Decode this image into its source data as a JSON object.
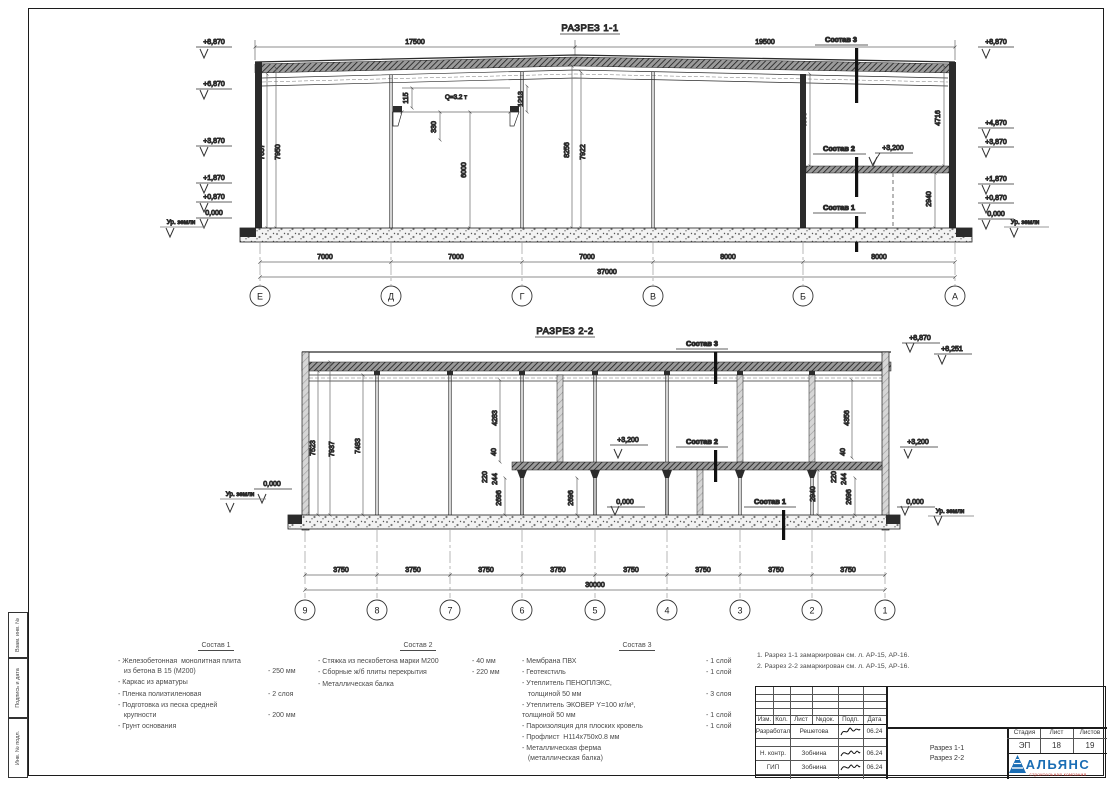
{
  "frame": {
    "side_stamp": {
      "cells": [
        "Взам. инв. №",
        "Подпись и дата",
        "Инв. № подл."
      ]
    }
  },
  "s1": {
    "title": "РАЗРЕЗ 1-1",
    "dim_top_left": "17500",
    "dim_top_right": "19500",
    "elev_left": {
      "e0": "+8,870",
      "e1": "+6,870",
      "e2": "+3,870",
      "e3": "+1,870",
      "e4": "+0,870",
      "e5": "0,000",
      "ground": "Ур. земли"
    },
    "elev_right": {
      "e0": "+8,870",
      "e1": "+4,870",
      "e2": "+3,870",
      "e3": "+1,870",
      "e4": "+0,870",
      "e5": "0,000",
      "ground": "Ур. земли"
    },
    "vdim": {
      "v7657": "7657",
      "v7950": "7950",
      "v115": "115",
      "v330": "330",
      "v6000": "6000",
      "v1213": "1213",
      "v8256": "8256",
      "v7922": "7922",
      "v4855": "4855",
      "v4716": "4716",
      "v2940": "2940"
    },
    "crane": "Q=3.2 т",
    "mezz_elev": "+3,200",
    "callout1": "Состав 1",
    "callout2": "Состав 2",
    "callout3": "Состав 3",
    "dims_bottom": [
      "7000",
      "7000",
      "7000",
      "8000",
      "8000"
    ],
    "dim_total": "37000",
    "axes": [
      "Е",
      "Д",
      "Г",
      "В",
      "Б",
      "А"
    ]
  },
  "s2": {
    "title": "РАЗРЕЗ 2-2",
    "elev": {
      "p8870": "+8,870",
      "p8251": "+8,251",
      "p3200": "+3,200",
      "zero": "0,000",
      "ground": "Ур. земли"
    },
    "vdim": {
      "v7523": "7523",
      "v7937": "7937",
      "v7483": "7483",
      "v4283": "4283",
      "v40": "40",
      "v220": "220",
      "v244": "244",
      "v2696": "2696",
      "v2940": "2940",
      "v4356": "4356"
    },
    "callout1": "Состав 1",
    "callout2": "Состав 2",
    "callout3": "Состав 3",
    "dims_bottom": [
      "3750",
      "3750",
      "3750",
      "3750",
      "3750",
      "3750",
      "3750",
      "3750"
    ],
    "dim_total": "30000",
    "axes": [
      "9",
      "8",
      "7",
      "6",
      "5",
      "4",
      "3",
      "2",
      "1"
    ]
  },
  "comp1": {
    "title": "Состав 1",
    "items": [
      {
        "name": "- Железобетонная  монолитная плита\n   из бетона В 15 (М200)",
        "value": "- 250 мм"
      },
      {
        "name": "- Каркас из арматуры",
        "value": ""
      },
      {
        "name": "- Пленка полиэтиленовая",
        "value": "- 2 слоя"
      },
      {
        "name": "- Подготовка из песка средней\n   крупности",
        "value": "- 200 мм"
      },
      {
        "name": "- Грунт основания",
        "value": ""
      }
    ]
  },
  "comp2": {
    "title": "Состав 2",
    "items": [
      {
        "name": "- Стяжка из пескобетона марки М200",
        "value": "- 40 мм"
      },
      {
        "name": "- Сборные ж/б плиты перекрытия",
        "value": "- 220 мм"
      },
      {
        "name": "- Металлическая балка",
        "value": ""
      }
    ]
  },
  "comp3": {
    "title": "Состав 3",
    "items": [
      {
        "name": "- Мембрана ПВХ",
        "value": "- 1 слой"
      },
      {
        "name": "- Геотекстиль",
        "value": "- 1 слой"
      },
      {
        "name": "- Утеплитель ПЕНОПЛЭКС,\n   толщиной 50 мм",
        "value": "- 3 слоя"
      },
      {
        "name": "- Утеплитель ЭКОВЕР Y=100 кг/м³,\nтолщиной 50 мм",
        "value": "- 1 слой"
      },
      {
        "name": "- Пароизоляция для плоских кровель",
        "value": "- 1 слой"
      },
      {
        "name": "- Профлист  Н114х750х0.8 мм",
        "value": ""
      },
      {
        "name": "- Металлическая ферма\n   (металлическая балка)",
        "value": ""
      }
    ]
  },
  "notes": {
    "n1": "1. Разрез 1-1 замаркирован см. л. АР-15, АР-16.",
    "n2": "2. Разрез 2-2 замаркирован см. л. АР-15, АР-16."
  },
  "stamp": {
    "cols": [
      "Изм.",
      "Кол.",
      "Лист",
      "№док.",
      "Подп.",
      "Дата"
    ],
    "rows": [
      {
        "role": "Разработал",
        "name": "Решетова",
        "date": "06.24"
      },
      {
        "role": "Н. контр.",
        "name": "Зобнина",
        "date": "06.24"
      },
      {
        "role": "ГИП",
        "name": "Зобнина",
        "date": "06.24"
      }
    ],
    "stage_label": "Стадия",
    "sheet_label": "Лист",
    "sheets_label": "Листов",
    "stage": "ЭП",
    "sheet": "18",
    "sheets": "19",
    "doc1": "Разрез 1-1",
    "doc2": "Разрез 2-2",
    "logo": "АЛЬЯНС",
    "logo_sub": "строительная компания"
  }
}
